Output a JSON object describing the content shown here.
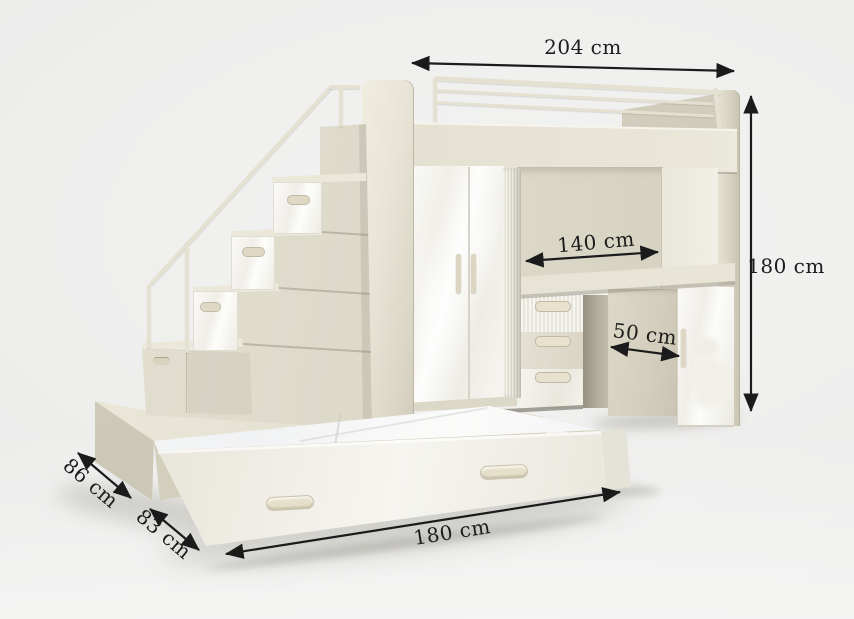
{
  "annotations": {
    "top_width": {
      "label": "204 cm"
    },
    "right_height": {
      "label": "180 cm"
    },
    "desk_width": {
      "label": "140 cm"
    },
    "cabinet_depth": {
      "label": "50 cm"
    },
    "upper_depth": {
      "label": "86 cm"
    },
    "lower_depth": {
      "label": "83 cm"
    },
    "bed_length": {
      "label": "180 cm"
    }
  },
  "palette": {
    "annotation_color": "#1c1c1c",
    "body_beige": "#ddd9c8",
    "body_beige_dark": "#cfc9b8",
    "front_gloss_white": "#f7f6f2",
    "rail_beige": "#e3dfd0",
    "background": "#ececeb"
  }
}
